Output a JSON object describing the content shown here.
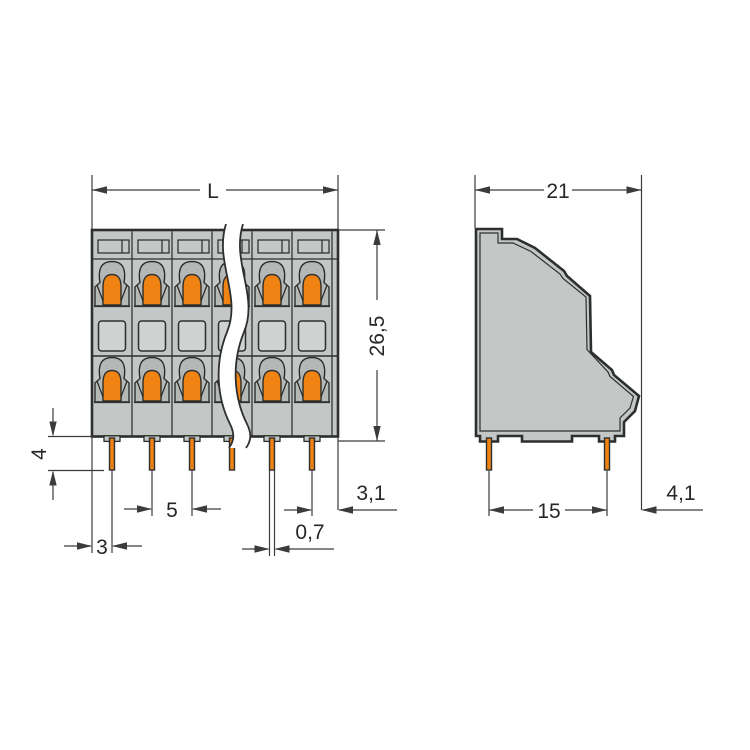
{
  "front_view": {
    "length_label": "L",
    "height_label": "26,5",
    "pin_length_label": "4",
    "pin_pitch_label": "5",
    "first_pin_offset_label": "3",
    "pin_width_label": "0,7",
    "last_pin_offset_label": "3,1"
  },
  "side_view": {
    "depth_label": "21",
    "pin_row_spacing_label": "15",
    "pin_back_offset_label": "4,1"
  },
  "colors": {
    "housing_gray": "#c3c7c6",
    "cage_gray": "#b4b8b7",
    "window_gray": "#ced2d1",
    "clamp_orange": "#ee8213",
    "outline_dark": "#2d2f2e",
    "dim_line": "#3a3c3b",
    "background": "#ffffff"
  }
}
